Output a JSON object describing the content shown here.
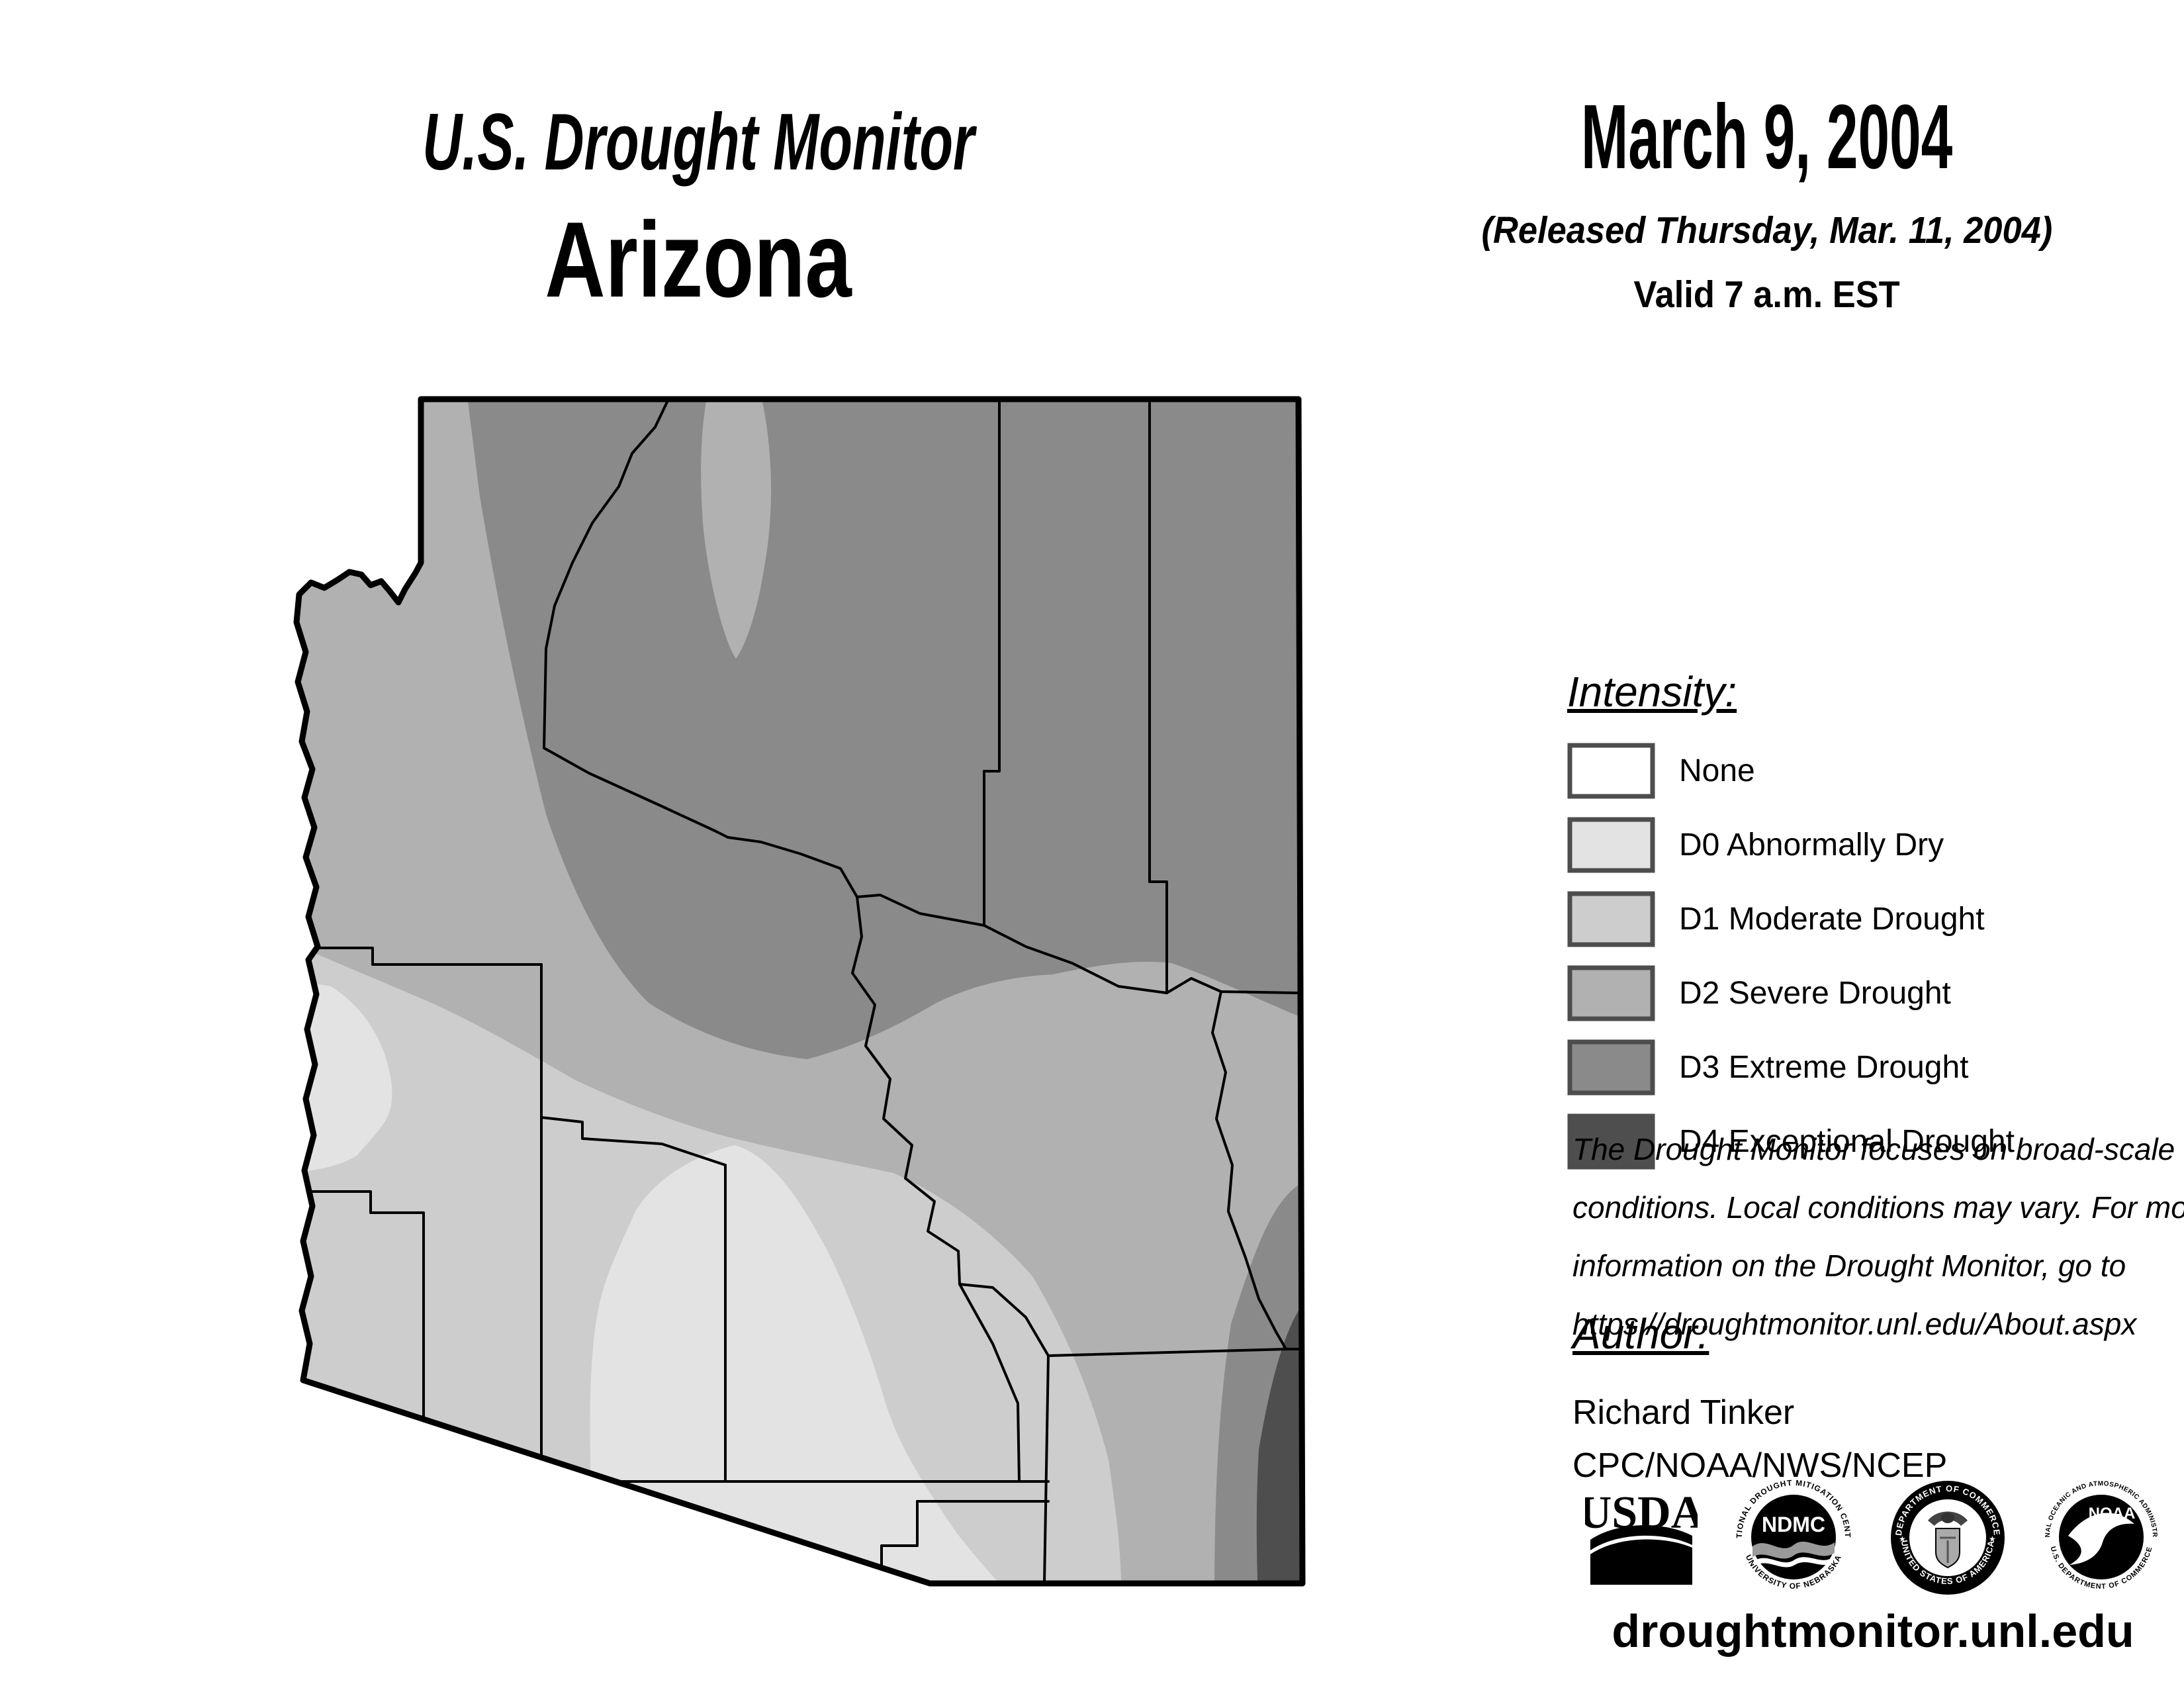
{
  "header": {
    "title": "U.S. Drought Monitor",
    "state": "Arizona",
    "date": "March 9, 2004",
    "released": "(Released Thursday, Mar. 11, 2004)",
    "valid": "Valid 7 a.m. EST"
  },
  "legend": {
    "heading": "Intensity:",
    "items": [
      {
        "code": "none",
        "label": "None",
        "color": "#ffffff"
      },
      {
        "code": "D0",
        "label": "D0 Abnormally Dry",
        "color": "#e3e3e3"
      },
      {
        "code": "D1",
        "label": "D1 Moderate Drought",
        "color": "#cdcdcd"
      },
      {
        "code": "D2",
        "label": "D2 Severe Drought",
        "color": "#b1b1b1"
      },
      {
        "code": "D3",
        "label": "D3 Extreme Drought",
        "color": "#8a8a8a"
      },
      {
        "code": "D4",
        "label": "D4 Exceptional Drought",
        "color": "#4e4e4e"
      }
    ],
    "swatch_border": "#4d4d4d"
  },
  "disclaimer": {
    "lines": [
      "The Drought Monitor focuses on broad-scale",
      "conditions. Local conditions may vary. For more",
      "information on the Drought Monitor, go to",
      "https://droughtmonitor.unl.edu/About.aspx"
    ]
  },
  "author": {
    "heading": "Author:",
    "name": "Richard Tinker",
    "org": "CPC/NOAA/NWS/NCEP"
  },
  "logos": {
    "usda": {
      "label": "USDA"
    },
    "ndmc": {
      "label": "NDMC",
      "ring_top": "NATIONAL DROUGHT MITIGATION CENTER",
      "ring_bottom": "UNIVERSITY OF NEBRASKA"
    },
    "doc": {
      "ring_top": "DEPARTMENT OF COMMERCE",
      "ring_bottom": "UNITED STATES OF AMERICA"
    },
    "noaa": {
      "label": "NOAA",
      "ring_top": "NATIONAL OCEANIC AND ATMOSPHERIC ADMINISTRATION",
      "ring_bottom": "U.S. DEPARTMENT OF COMMERCE"
    }
  },
  "footer": {
    "url": "droughtmonitor.unl.edu"
  },
  "map": {
    "state": "Arizona",
    "regions": [
      {
        "level": "D3 Extreme Drought",
        "area": "northeast and north-central Arizona"
      },
      {
        "level": "D2 Severe Drought",
        "area": "northwest strip, central belt and east-central Arizona"
      },
      {
        "level": "D1 Moderate Drought",
        "area": "west-central and southwestern Arizona"
      },
      {
        "level": "D0 Abnormally Dry",
        "area": "south-central Arizona and a small pocket on the western border"
      },
      {
        "level": "D3 Extreme Drought",
        "area": "far southeastern band"
      },
      {
        "level": "D4 Exceptional Drought",
        "area": "extreme southeast corner"
      }
    ]
  }
}
